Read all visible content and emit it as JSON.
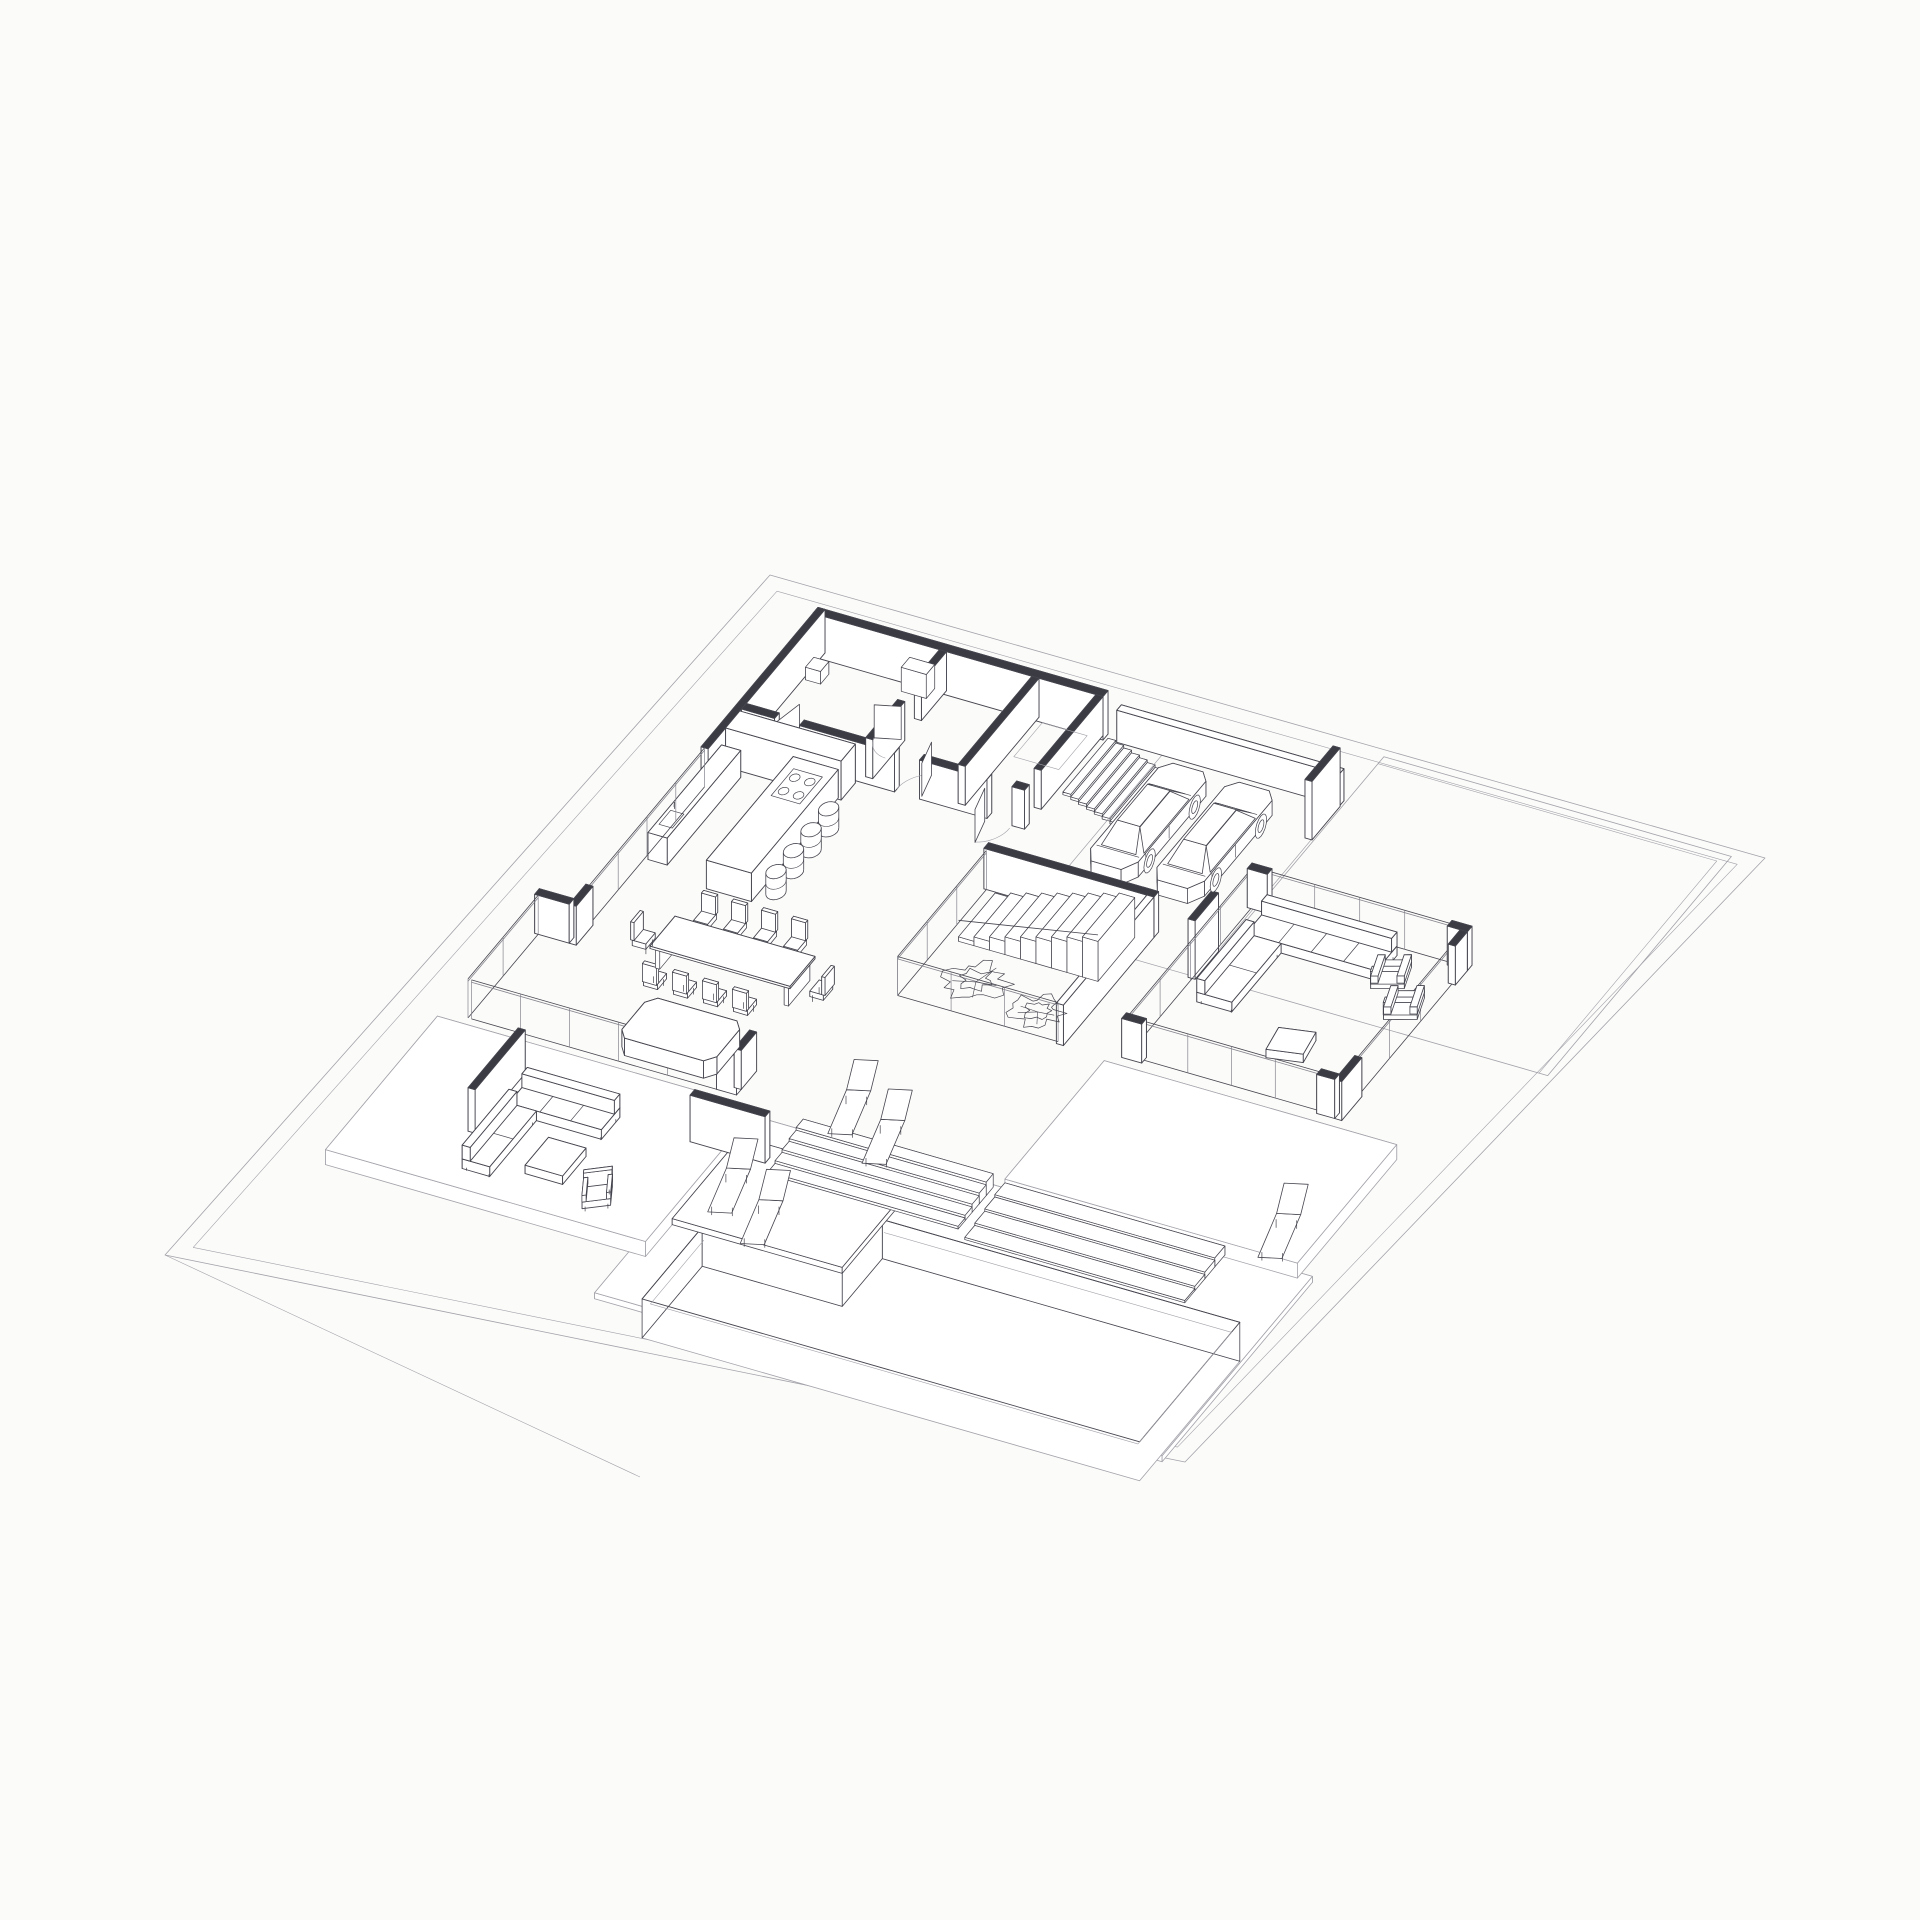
{
  "meta": {
    "title": "Axonometric ground-floor plan of a modern villa",
    "drawing_type": "architectural plan-oblique axonometric, hidden-line wireframe",
    "background_note": "white sheet, no text or annotations visible"
  },
  "colors": {
    "background": "#fbfbf9",
    "line": "#45454f",
    "line_light": "#a2a2aa",
    "wall_cap": "#3b3b43",
    "face": "#ffffff",
    "glass": "#84848e"
  },
  "scene": {
    "site": {
      "label": "trapezoidal site plot with terraced ground"
    },
    "rooms": [
      {
        "name": "utility-and-bath-rooms",
        "doors": 4
      },
      {
        "name": "kitchen-dining-great-room"
      },
      {
        "name": "entry-with-exterior-stair",
        "stair_treads": 7
      },
      {
        "name": "garage-carport",
        "cars": 2
      },
      {
        "name": "courtyard-atrium",
        "trees": 2,
        "stair_treads": 9
      },
      {
        "name": "living-room"
      },
      {
        "name": "west-terrace"
      },
      {
        "name": "pool-deck"
      },
      {
        "name": "swimming-pool",
        "state": "empty, with swim-out platform"
      }
    ],
    "furniture": {
      "bar_stools": 4,
      "dining_chairs": 10,
      "dining_tables": 1,
      "kitchen_island": 1,
      "kitchen_counter_with_sink": 1,
      "tall_cabinet_run": 1,
      "daybed": 1,
      "indoor_sofa_sections": 2,
      "indoor_armchairs": 2,
      "ottomans": 1,
      "outdoor_sofa_sections": 2,
      "outdoor_armchairs": 1,
      "outdoor_coffee_tables": 1,
      "sun_loungers": 5,
      "cars": 2,
      "trees": 2
    }
  }
}
